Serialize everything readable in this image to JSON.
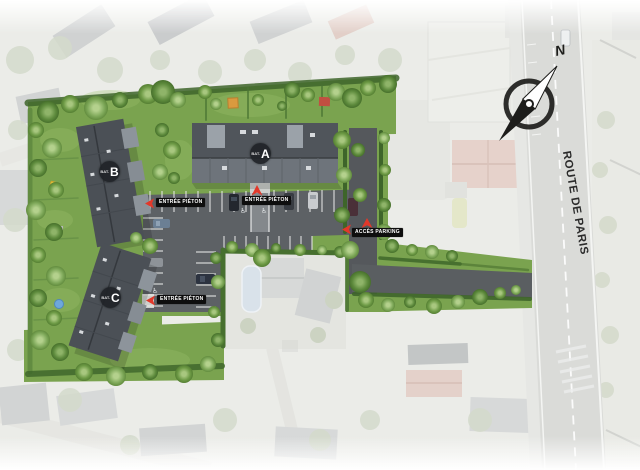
{
  "site_plan": {
    "road_label": "ROUTE DE PARIS",
    "compass_north": "N",
    "buildings": [
      {
        "id": "A",
        "prefix": "BAT.",
        "letter": "A"
      },
      {
        "id": "B",
        "prefix": "BAT.",
        "letter": "B"
      },
      {
        "id": "C",
        "prefix": "BAT.",
        "letter": "C"
      }
    ],
    "signs": [
      {
        "id": "pedestrian-entrance-north-west",
        "label": "ENTRÉE PIÉTON",
        "arrow": "left"
      },
      {
        "id": "pedestrian-entrance-center",
        "label": "ENTRÉE PIÉTON",
        "arrow": "up"
      },
      {
        "id": "pedestrian-entrance-south-west",
        "label": "ENTRÉE PIÉTON",
        "arrow": "left"
      },
      {
        "id": "parking-access",
        "label": "ACCÈS PARKING",
        "arrow": "up-left"
      }
    ],
    "colors": {
      "arrow_red": "#e2382a",
      "sign_background": "#0e0e0e",
      "sign_text": "#ffffff",
      "badge_background": "#24282c",
      "badge_text": "#ffffff",
      "road_text": "#2b2b2b",
      "site_lawn": "#7aa34f",
      "roof_dark": "#4b5056",
      "roof_light": "#9ba2a9",
      "asphalt": "#5d6165",
      "highway": "#dadbd8"
    }
  }
}
